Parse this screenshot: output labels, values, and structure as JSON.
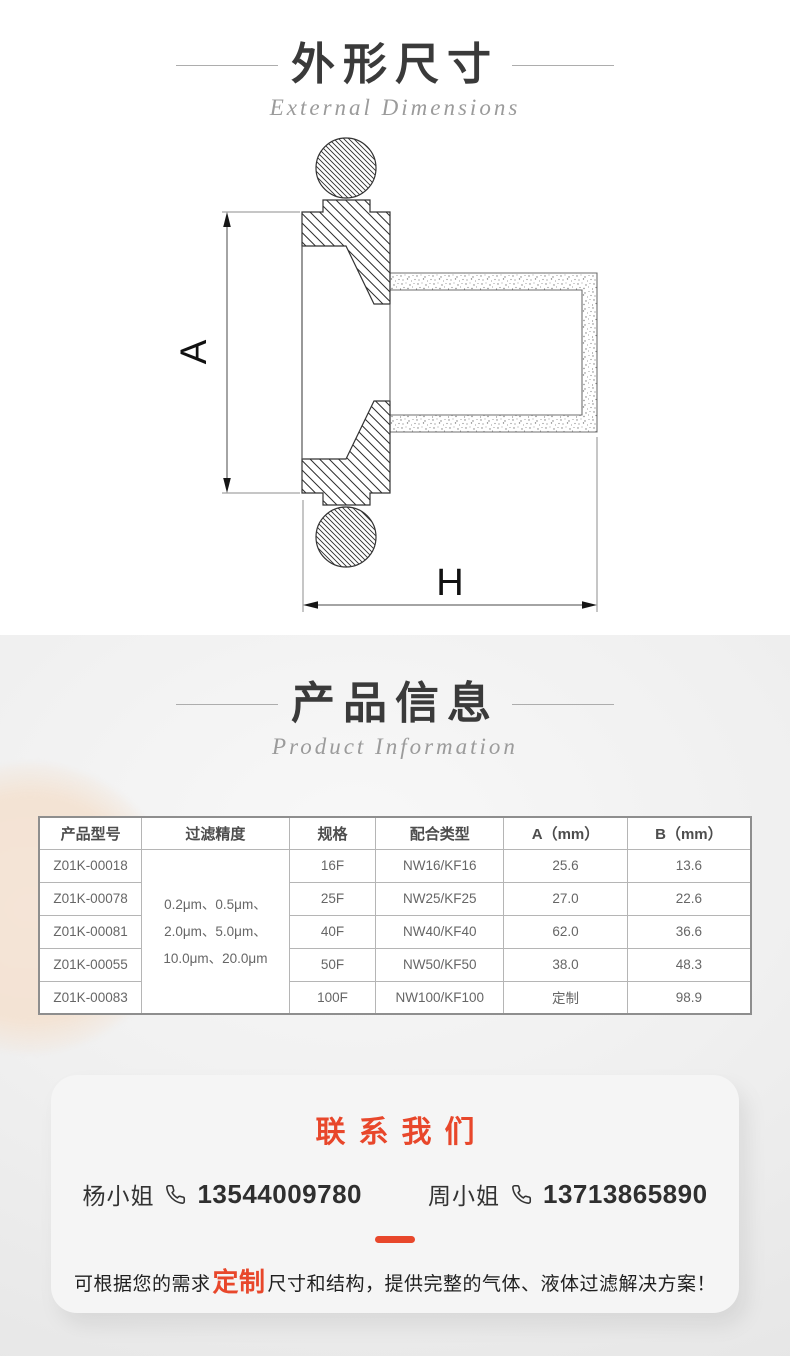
{
  "section_dimensions": {
    "title": "外形尺寸",
    "subtitle": "External Dimensions",
    "drawing": {
      "label_a": "A",
      "label_h": "H"
    }
  },
  "section_product": {
    "title": "产品信息",
    "subtitle": "Product Information",
    "table": {
      "headers": [
        "产品型号",
        "过滤精度",
        "规格",
        "配合类型",
        "A（mm）",
        "B（mm）"
      ],
      "filter_precision": "0.2μm、0.5μm、\n2.0μm、5.0μm、\n10.0μm、20.0μm",
      "rows": [
        {
          "model": "Z01K-00018",
          "spec": "16F",
          "match": "NW16/KF16",
          "a": "25.6",
          "b": "13.6"
        },
        {
          "model": "Z01K-00078",
          "spec": "25F",
          "match": "NW25/KF25",
          "a": "27.0",
          "b": "22.6"
        },
        {
          "model": "Z01K-00081",
          "spec": "40F",
          "match": "NW40/KF40",
          "a": "62.0",
          "b": "36.6"
        },
        {
          "model": "Z01K-00055",
          "spec": "50F",
          "match": "NW50/KF50",
          "a": "38.0",
          "b": "48.3"
        },
        {
          "model": "Z01K-00083",
          "spec": "100F",
          "match": "NW100/KF100",
          "a": "定制",
          "b": "98.9"
        }
      ]
    }
  },
  "contact": {
    "title": "联系我们",
    "accent_color": "#e8472b",
    "phone_icon": "handset-outline",
    "contacts": [
      {
        "name": "杨小姐",
        "phone": "13544009780"
      },
      {
        "name": "周小姐",
        "phone": "13713865890"
      }
    ],
    "note": {
      "prefix": "可根据您的需求",
      "highlight": "定制",
      "suffix": "尺寸和结构，提供完整的气体、液体过滤解决方案！"
    }
  }
}
